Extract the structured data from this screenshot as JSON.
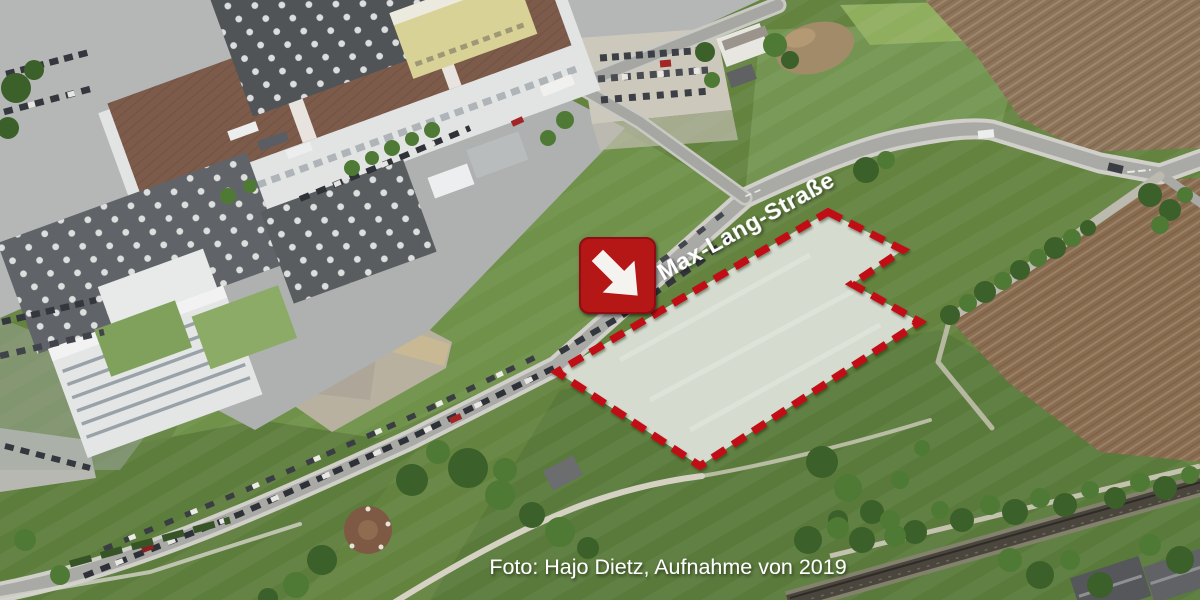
{
  "image": {
    "street_label": "Max-Lang-Straße",
    "photo_credit": "Foto: Hajo Dietz, Aufnahme von 2019"
  },
  "annotations": {
    "site_marker_icon": "arrow-down-right-icon",
    "marker_color": "#b51318",
    "marker_arrow_color": "#f4f3f0",
    "outline_color": "#c01018",
    "outline_style": "dashed",
    "site_fill_color": "#d6dbd0",
    "label_text_color": "#ffffff"
  }
}
